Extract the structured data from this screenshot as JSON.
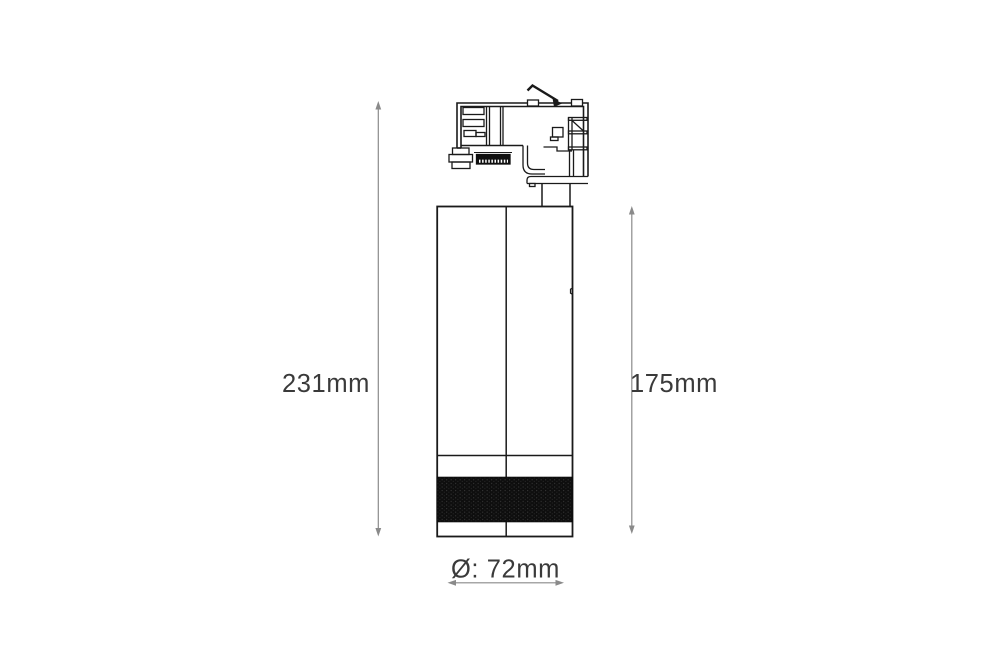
{
  "page": {
    "background": "#ffffff"
  },
  "drawing": {
    "subject": "track-light-fixture-dimension-drawing",
    "view": "side-elevation",
    "line_color": "#1a1a1a",
    "dimension_line_color": "#8a8a8a",
    "label_color": "#3a3a3a",
    "knurl_band_color": "#101010",
    "parts": [
      "track-adapter",
      "adapter-lock-lever",
      "terminal-strip",
      "adapter-stem",
      "cylindrical-body",
      "knurled-band"
    ]
  },
  "dimensions": {
    "overall_height": {
      "label": "231mm",
      "orientation": "vertical",
      "side": "left"
    },
    "body_height": {
      "label": "175mm",
      "orientation": "vertical",
      "side": "right"
    },
    "diameter": {
      "label": "Ø: 72mm",
      "orientation": "horizontal",
      "side": "bottom"
    }
  }
}
